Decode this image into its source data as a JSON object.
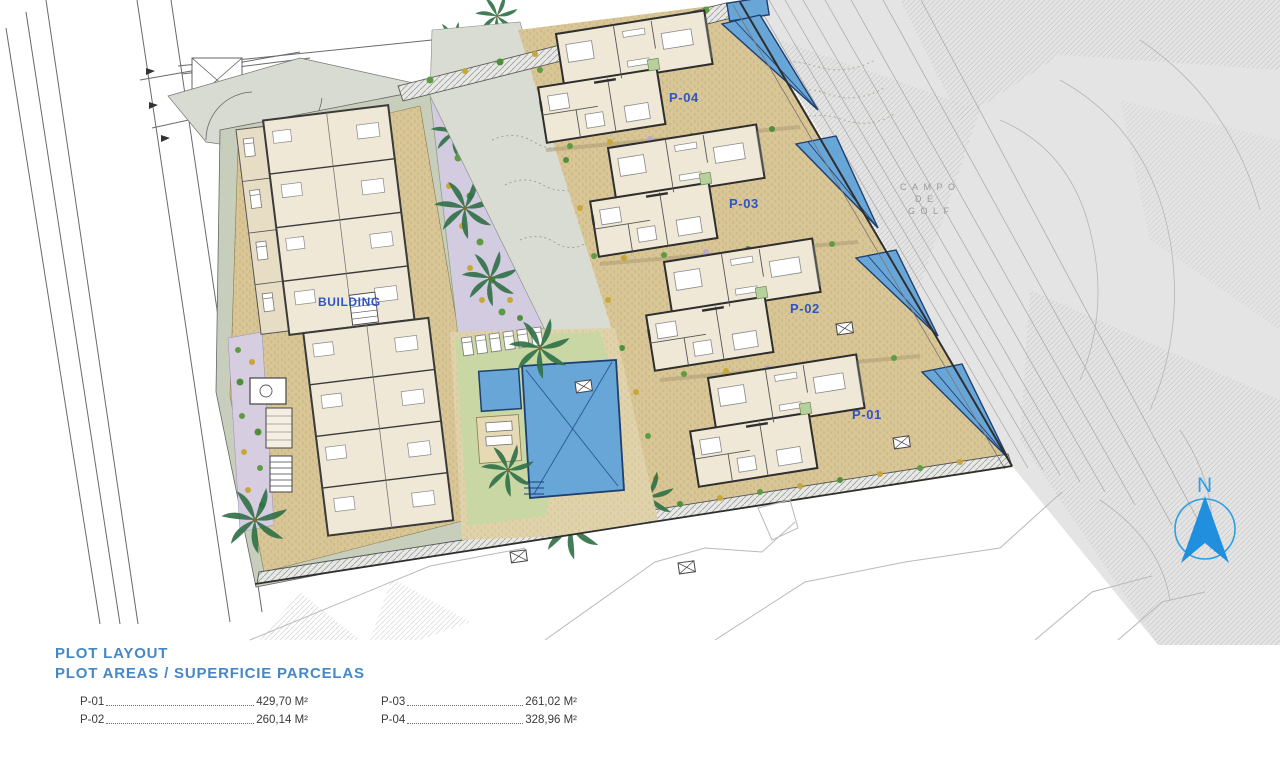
{
  "plan": {
    "labels": {
      "building": "BUILDING",
      "p01": "P-01",
      "p02": "P-02",
      "p03": "P-03",
      "p04": "P-04"
    },
    "golf": {
      "line1": "CAMPO",
      "line2": "DE",
      "line3": "GOLF"
    },
    "north_label": "N"
  },
  "legend": {
    "title": "PLOT LAYOUT",
    "subtitle": "PLOT AREAS / SUPERFICIE PARCELAS",
    "entries": [
      {
        "label": "P-01",
        "value": "429,70 M²"
      },
      {
        "label": "P-02",
        "value": "260,14 M²"
      },
      {
        "label": "P-03",
        "value": "261,02 M²"
      },
      {
        "label": "P-04",
        "value": "328,96 M²"
      }
    ]
  },
  "colors": {
    "label_blue": "#2f55c4",
    "legend_blue": "#4587c7",
    "pool_blue": "#69a6d8",
    "north_blue": "#2d9fe3",
    "plot_tan": "#d9c697",
    "lawn_green": "#c9d7a4",
    "sage_border": "#c7cebc",
    "garden_lavender": "#d6cde1",
    "golf_gray": "#e4e4e4",
    "path_gray": "#d9dcd3"
  }
}
